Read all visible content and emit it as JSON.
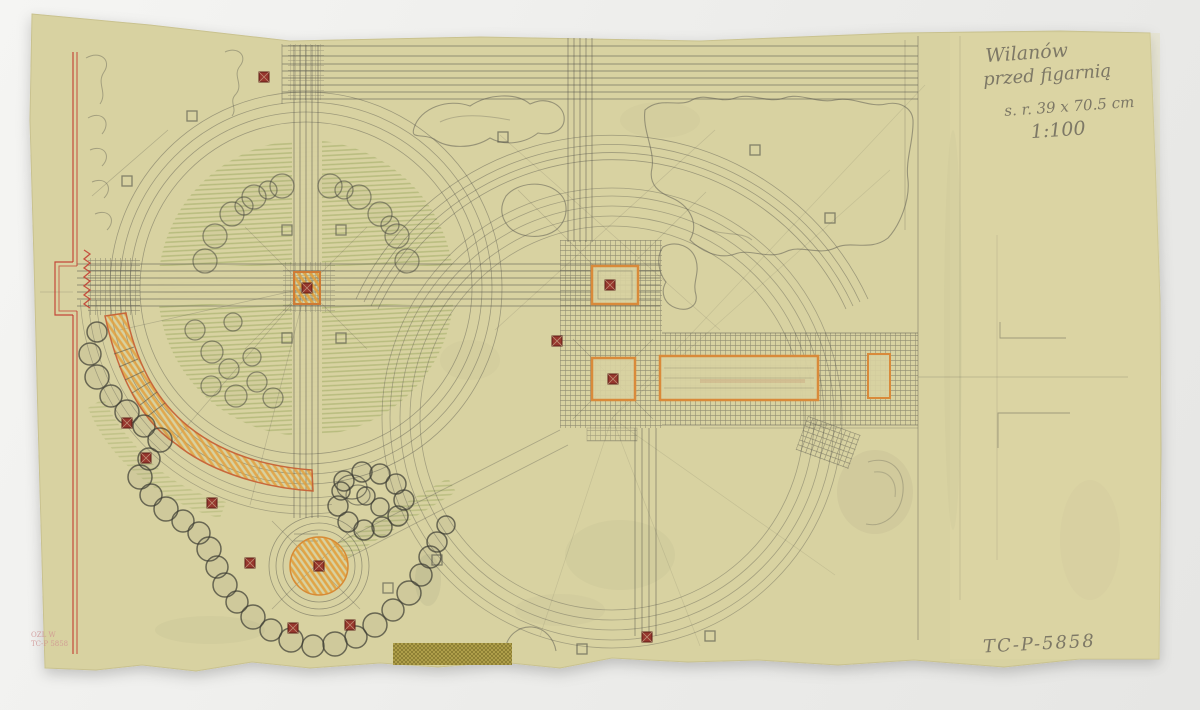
{
  "annotations": {
    "line1": "Wilanów",
    "line2": "przed figarnią",
    "line3": "s. r. 39 x 70.5 cm",
    "line4": "1:100",
    "catalog_number": "TC-P-5858"
  },
  "stamp": {
    "line1": "OZL W",
    "line2": "TC-P 5858"
  },
  "colors": {
    "background": "#eff0ee",
    "paper": "#d8d2a1",
    "pencil": "#56554c",
    "green_crayon": "#95a457",
    "orange_crayon": "#e2a03b",
    "orange_outline": "#c96a35",
    "red_ink": "#c2392e",
    "dark_red_marker": "#8f322b",
    "stamp_red": "#d09191",
    "tape": "#b3a24c"
  }
}
